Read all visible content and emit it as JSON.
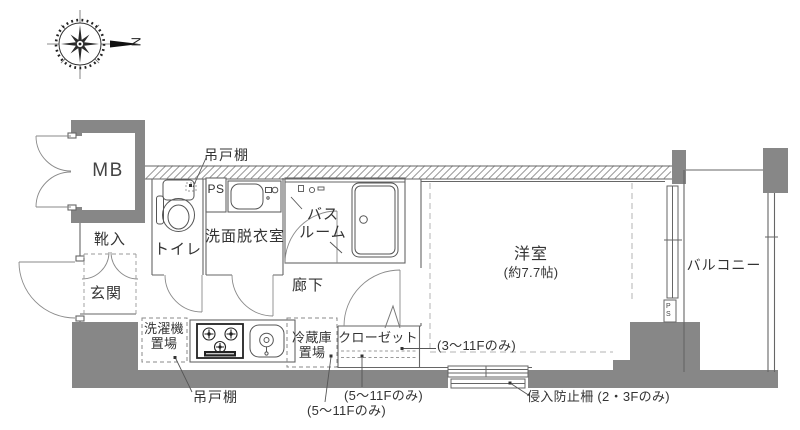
{
  "colors": {
    "wall_gray": "#878787",
    "line_gray": "#666666",
    "text": "#333333"
  },
  "compass": {
    "north_label": "N"
  },
  "rooms": {
    "meter_box": "MB",
    "shoe_cabinet": "靴入",
    "entrance": "玄関",
    "toilet": "トイレ",
    "pipe_space": "PS",
    "washroom": "洗面脱衣室",
    "bathroom": "バス\nルーム",
    "hallway": "廊下",
    "washer_space": "洗濯機\n置場",
    "fridge_space": "冷蔵庫\n置場",
    "closet": "クローゼット",
    "western_room": "洋室",
    "western_room_size": "(約7.7帖)",
    "balcony": "バルコニー",
    "pipe_space_small": "PS"
  },
  "annotations": {
    "hanging_cupboard_top": "吊戸棚",
    "hanging_cupboard_bottom": "吊戸棚",
    "floors_3_to_11_only": "(3〜11Fのみ)",
    "floors_5_to_11_only_closet": "(5〜11Fのみ)",
    "floors_5_to_11_only_fridge": "(5〜11Fのみ)",
    "intrusion_fence_floors_2_3": "侵入防止柵 (2・3Fのみ)"
  }
}
